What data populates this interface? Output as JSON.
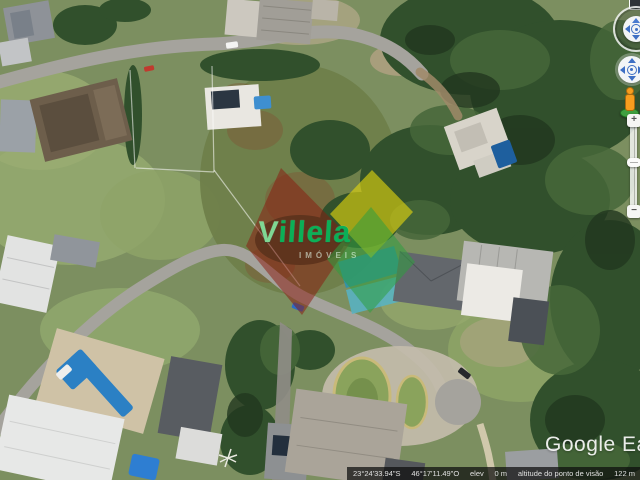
{
  "logo": {
    "text": "Google Earth"
  },
  "watermark": {
    "brand_initial": "V",
    "brand_rest": "illela",
    "subtext": "IMÓVEIS",
    "colors": {
      "diamond_red": "#8a1a0f",
      "diamond_yellow": "#e3d60e",
      "diamond_green": "#2f9e3f",
      "brand_text": "#0bb057"
    }
  },
  "status_bar": {
    "latitude": "23°24'33.94\"S",
    "longitude": "46°17'11.49\"O",
    "elevation_label": "elev",
    "elevation_value": "0 m",
    "view_altitude_label": "altitude do ponto de visão",
    "view_altitude_value": "122 m"
  },
  "controls": {
    "zoom_in_label": "+",
    "zoom_out_label": "−",
    "icons": [
      "look-joystick-icon",
      "pan-joystick-icon",
      "pegman-icon",
      "zoom-slider",
      "north-marker"
    ],
    "arrow_color": "#3e6fc4",
    "pegman_color": "#f79d1e"
  }
}
